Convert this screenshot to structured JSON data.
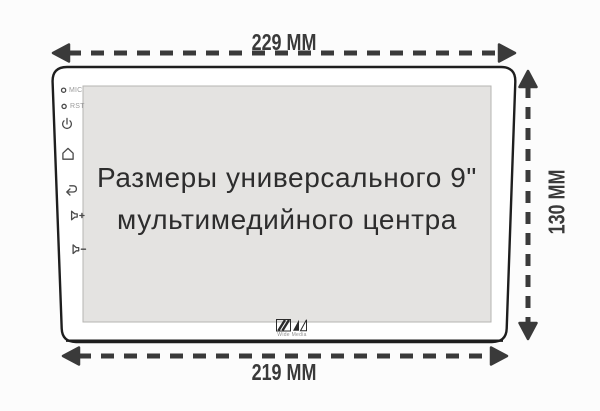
{
  "title": "Размеры универсального 9\" мультимедийного центра",
  "screen": {
    "line1": "Размеры универсального 9\"",
    "line2": "мультимедийного центра"
  },
  "dimensions": {
    "top": "229 MM",
    "bottom": "219 MM",
    "right": "130 MM"
  },
  "side_panel": {
    "mic": "MIC",
    "rst": "RST",
    "icons": [
      "mic-led-icon",
      "rst-led-icon",
      "power-icon",
      "home-icon",
      "back-icon",
      "volume-up-icon",
      "volume-down-icon"
    ]
  },
  "logo": {
    "caption": "Wide Media"
  },
  "colors": {
    "background": "#fcfcfc",
    "dimension_line": "#3a3a3a",
    "device_outline": "#1e1e1e",
    "screen_bg": "#e4e3e1",
    "screen_text": "#2d2d2d",
    "bezel_icon": "#4a4a4a",
    "bezel_label": "#9a9a9a"
  }
}
